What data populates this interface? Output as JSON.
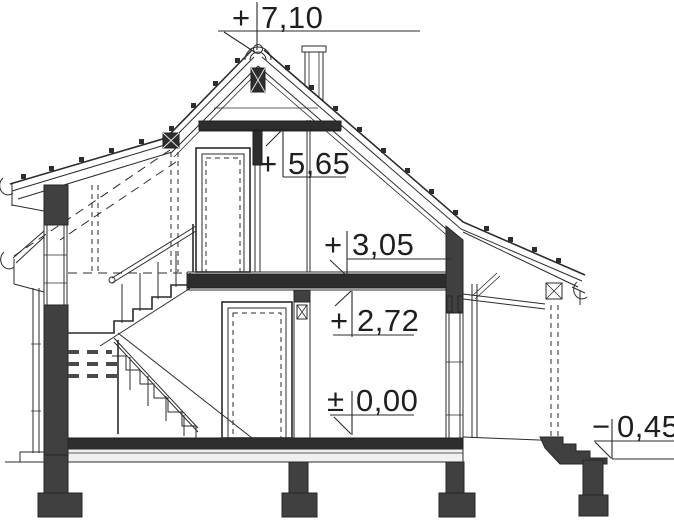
{
  "drawing": {
    "type": "house-cross-section",
    "background": "#ffffff",
    "ink_color": "#2b2b2b",
    "cut_wall_color": "#404040",
    "slab_color": "#2d2d2d",
    "levels": [
      {
        "id": "ridge",
        "prefix": "+",
        "value": "7,10"
      },
      {
        "id": "collar-beam",
        "prefix": "+",
        "value": "5,65"
      },
      {
        "id": "attic-floor",
        "prefix": "+",
        "value": "3,05"
      },
      {
        "id": "ground-ceiling",
        "prefix": "+",
        "value": "2,72"
      },
      {
        "id": "ground-floor",
        "prefix": "±",
        "value": "0,00"
      },
      {
        "id": "terrace",
        "prefix": "−",
        "value": "0,45"
      }
    ]
  }
}
